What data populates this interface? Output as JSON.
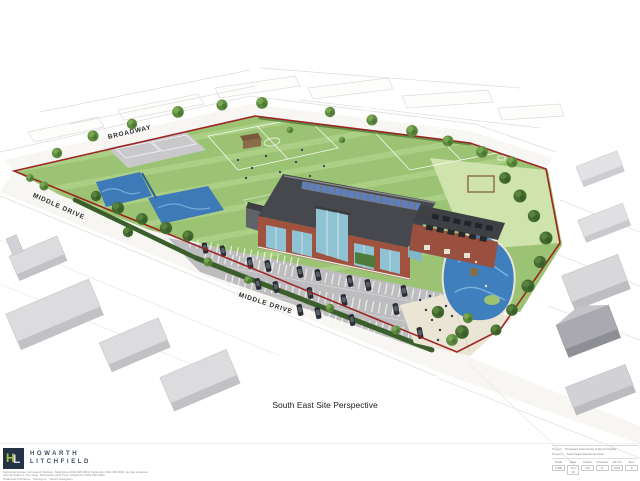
{
  "drawing": {
    "streets": {
      "broadway": "BROADWAY",
      "middle_drive_west": "MIDDLE DRIVE",
      "middle_drive_south": "MIDDLE DRIVE"
    },
    "caption": "South East Site Perspective",
    "boundary_color": "#9b1c1c",
    "palette": {
      "field_green": "#9cc273",
      "light_green": "#cfe3ac",
      "water_play_blue": "#3f7fbe",
      "parking_grey": "#bdbdbf",
      "brick": "#a0523f",
      "roof_grey": "#46484d",
      "solar_blue": "#5b7fc4"
    }
  },
  "footer": {
    "logo": {
      "h": "H",
      "l": "L"
    },
    "firm": {
      "line1": "HOWARTH",
      "line2": "LITCHFIELD"
    },
    "address_lines": [
      "Fernwood House, Fernwood, Durham. Telephone 0191 000 0000. Facsimile 0191 000 0001. E-mail enquiries",
      "Also at Studio 2, The Gate, Newcastle upon Tyne. Telephone 0191 000 0002",
      "Chartered Architects  ·  Surveyors  ·  Interior Designers"
    ]
  },
  "title_block": {
    "project_label": "Project:",
    "project_value": "Proposed Community & Sports Facility",
    "drawing_label": "Drawing:",
    "drawing_value": "South East Site Perspective",
    "fields": [
      {
        "label": "Scale",
        "value": "1:500"
      },
      {
        "label": "Date",
        "value": "Jun 16"
      },
      {
        "label": "Drawn",
        "value": "DH"
      },
      {
        "label": "Checked",
        "value": "JL"
      },
      {
        "label": "Job No",
        "value": "2016"
      },
      {
        "label": "Rev",
        "value": "A"
      }
    ]
  }
}
